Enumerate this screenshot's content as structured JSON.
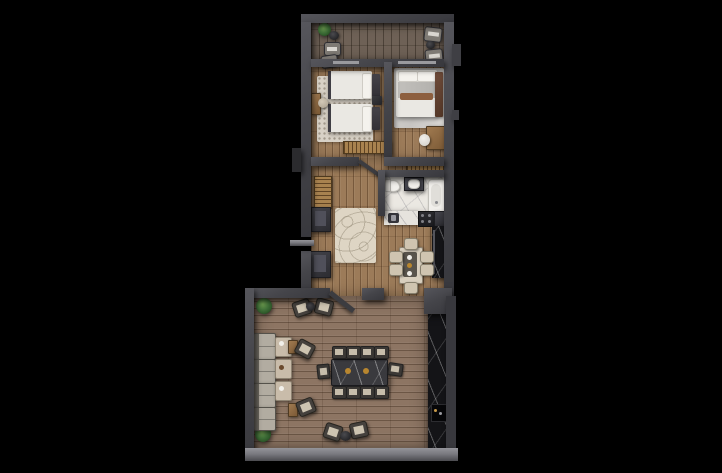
{
  "scene": {
    "type": "3d-rendered-apartment-floor-plan",
    "background_color": "#000000",
    "aria": "Top-down 3D rendering of an apartment floor plan on a black background"
  },
  "palette": {
    "wall": "#45454a",
    "wall_bottom_light": "#8a8a90",
    "floor_bedroom_wood": "#9c7b59",
    "floor_living_wood": "#8d7563",
    "floor_balcony_wood": "#6e6156",
    "bathroom_marble": "#ebe8e2",
    "counter_marble": "#e6e3dd",
    "media_wall_marble": "#141417",
    "rug_cream": "#d8d1c6",
    "rug_hall": "#ded5c4",
    "bedding_white": "#eae8e3",
    "blanket_gray": "#bcbab6",
    "accent_pillow_brown": "#8d5f3f",
    "wood_accent": "#a8824f",
    "sofa_fabric": "#b2aca1",
    "chair_dark": "#45413d",
    "cushion_light": "#cdc4b1",
    "dining_chair": "#cfc4b0",
    "plant_green": "#3f6f38",
    "table_brass_accent": "#b8862f"
  },
  "rooms": [
    {
      "name": "balcony",
      "aria": "Balcony with plant, two side tables and four chairs"
    },
    {
      "name": "twin-bedroom",
      "aria": "Bedroom with two single beds, speckled rug, nightstand, desk chair and slatted bench"
    },
    {
      "name": "double-bedroom",
      "aria": "Bedroom with double bed, brown accent pillow, rug, desk and chair"
    },
    {
      "name": "hallway",
      "aria": "Hallway with patterned rug, radiator, two dark cabinets and entrance door"
    },
    {
      "name": "bathroom",
      "aria": "Bathroom with toilet, vanity sink and bathtub on marble tile"
    },
    {
      "name": "kitchen-dining",
      "aria": "Kitchen with marble counter, sink, stove, tall cabinet and six-seat dining table"
    },
    {
      "name": "living-room",
      "aria": "Large living room with ten-seat conference table, lounge seating row, scattered chairs, corner plants and dark marble media wall"
    }
  ]
}
